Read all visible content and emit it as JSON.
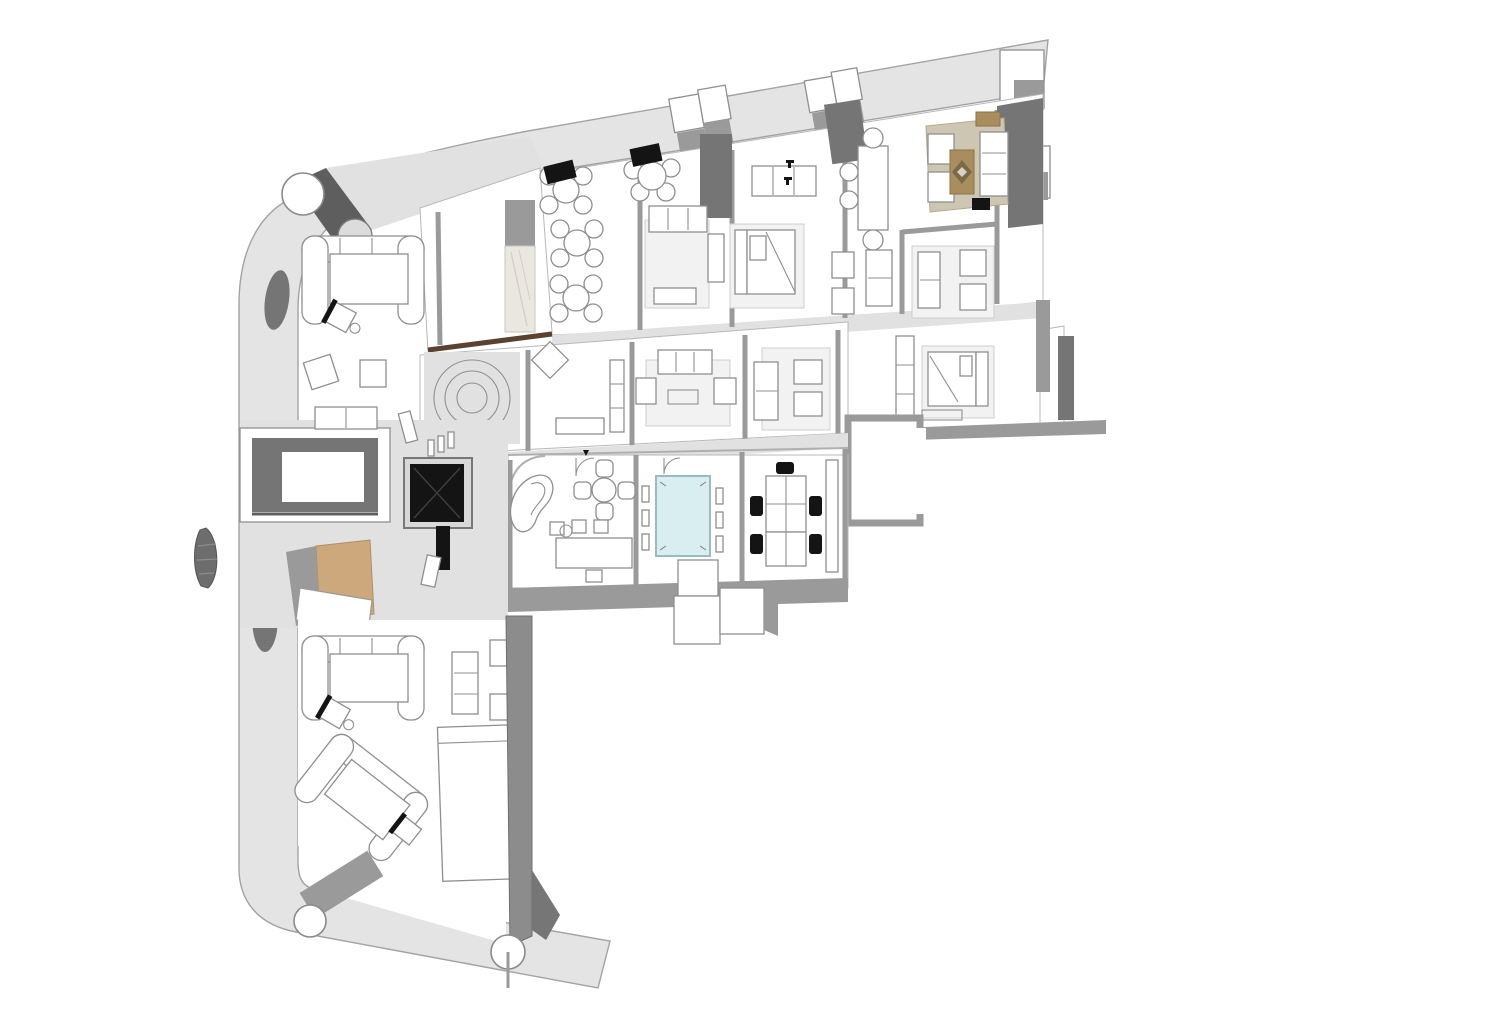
{
  "meta": {
    "content_type": "3d-floor-plan-rendering",
    "render_style": "sketchup-axonometric-top-view",
    "visible_text": "none"
  },
  "colors": {
    "background": "#ffffff",
    "shell": "#e4e4e4",
    "shell_edge": "#a3a3a3",
    "floor": "#ffffff",
    "corridor": "#e1e1e1",
    "wall_mid": "#9a9a9a",
    "wall_dark": "#757575",
    "wall_darker": "#5e5e5e",
    "black": "#141414",
    "furniture_stroke": "#8f8f8f",
    "rug": "#f2f2f2",
    "tan_rug": "#ccc6b3",
    "tan_floor": "#cda87d",
    "wood_tan": "#a98d5f",
    "wood_brown": "#5a4130",
    "pool_table": "#d9eef1",
    "pool_table_edge": "#9bbcbe",
    "marble": "#eae7e0"
  },
  "plan": {
    "shell": {
      "shape": "curved-L",
      "elements": [
        "outer-wall-band",
        "round-columns",
        "vent-shaft-boxes",
        "corner-tower",
        "shade-wedges",
        "bottom-diagonal-band"
      ]
    },
    "zones": [
      {
        "name": "entry-balcony",
        "furniture": [
          "diagonal-wall",
          "round-column",
          "cylinder-column"
        ]
      },
      {
        "name": "wardrobe-entry",
        "furniture": [
          "tall-marble-wardrobe",
          "partition-wall",
          "wood-threshold"
        ]
      },
      {
        "name": "cafe-lounge",
        "furniture": [
          "round-table-4-chairs x4",
          "wall-screen-black x2"
        ]
      },
      {
        "name": "living-room-1",
        "furniture": [
          "sofa",
          "coffee-table",
          "side-cabinet",
          "rug"
        ]
      },
      {
        "name": "bedroom-1",
        "furniture": [
          "double-bed",
          "headboard",
          "closet-shelf",
          "rug"
        ]
      },
      {
        "name": "dining-nook",
        "furniture": [
          "dining-table",
          "chairs",
          "door-hardware-marks"
        ]
      },
      {
        "name": "sitting-nook",
        "furniture": [
          "armchair x2",
          "loveseat"
        ]
      },
      {
        "name": "sitting-room",
        "furniture": [
          "loveseat",
          "armchair x2",
          "rug"
        ]
      },
      {
        "name": "lounge-top-right",
        "furniture": [
          "armchair x2",
          "sofa",
          "wood-coffee-table-diamond",
          "sideboard",
          "beige-rug",
          "tv-black"
        ]
      },
      {
        "name": "gallery-room",
        "furniture": [
          "rotated-chair",
          "bench",
          "shelf"
        ]
      },
      {
        "name": "round-feature",
        "furniture": [
          "concentric-circle-table"
        ]
      },
      {
        "name": "living-nook-1",
        "furniture": [
          "sofa",
          "armchair x2",
          "rug",
          "coffee-table"
        ]
      },
      {
        "name": "living-nook-2",
        "furniture": [
          "sofa",
          "armchair x2",
          "rug"
        ]
      },
      {
        "name": "bedroom-2",
        "furniture": [
          "double-bed",
          "closet",
          "rug",
          "bench"
        ]
      },
      {
        "name": "terrace-box",
        "furniture": [
          "open-walls"
        ]
      },
      {
        "name": "reception",
        "furniture": [
          "kidney-sofa",
          "four-seat-cross-table",
          "desk",
          "stools",
          "door-arc x2"
        ]
      },
      {
        "name": "conference-room",
        "furniture": [
          "glass-table-cyan",
          "side-chair x6",
          "door-arc"
        ]
      },
      {
        "name": "office",
        "furniture": [
          "desk-cluster x2",
          "task-chair-black x5",
          "tall-cabinet"
        ]
      },
      {
        "name": "stair-void",
        "furniture": [
          "open-void"
        ]
      },
      {
        "name": "elevator-core",
        "furniture": [
          "elevator-cab-black",
          "railing x2"
        ]
      },
      {
        "name": "tan-room",
        "furniture": [
          "tan-floor",
          "white-slab"
        ]
      },
      {
        "name": "executive-lounge-1",
        "furniture": [
          "u-sofa",
          "desk",
          "task-chair"
        ]
      },
      {
        "name": "executive-lounge-2",
        "furniture": [
          "u-sofa-rotated",
          "desk",
          "task-chair"
        ]
      },
      {
        "name": "sofa-corner",
        "furniture": [
          "sofa",
          "armchair x2"
        ]
      },
      {
        "name": "storage-closet",
        "furniture": [
          "outline-rectangle"
        ]
      },
      {
        "name": "spine-wall",
        "furniture": [
          "tall-gray-wall",
          "round-column x2"
        ]
      }
    ]
  }
}
